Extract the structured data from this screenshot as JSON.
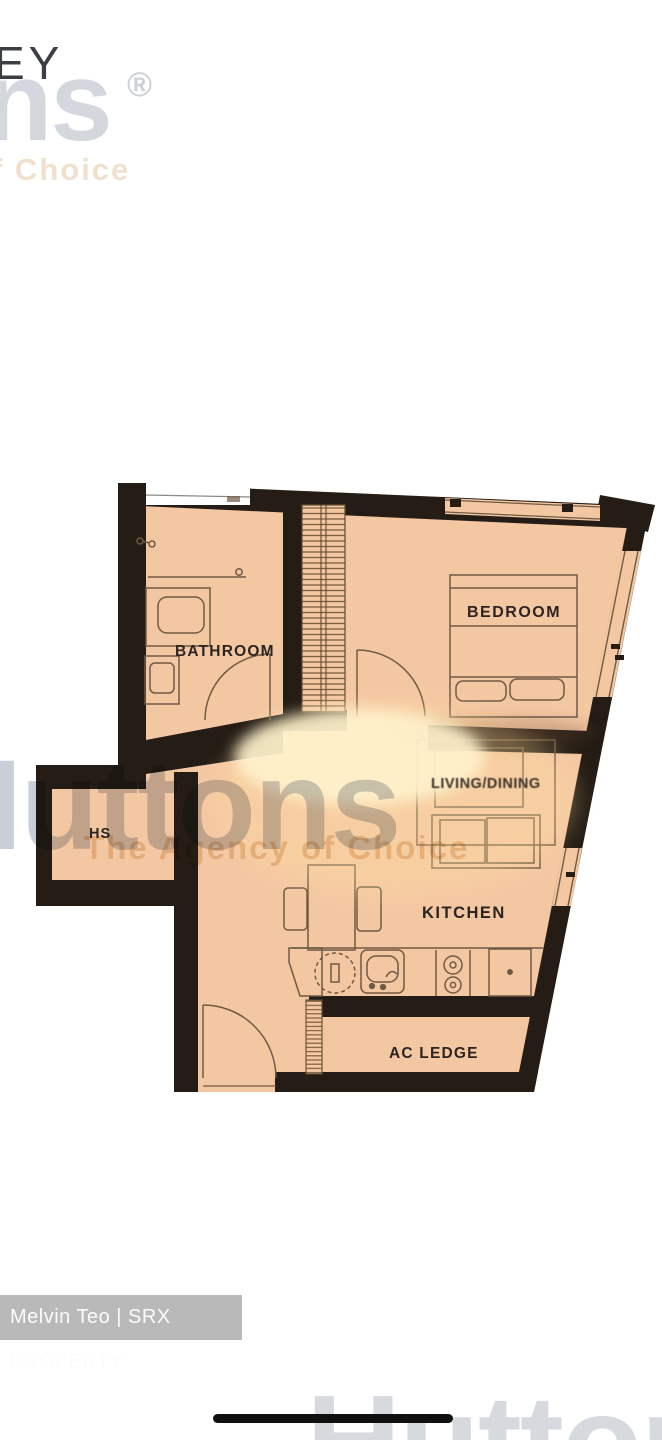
{
  "colors": {
    "floor": "#f4c7a3",
    "wall": "#241c15",
    "fixture_line": "#6f5a44",
    "glow": "#fff3cd",
    "watermark_gray": "#c9ced8",
    "watermark_tan": "#edd9bd",
    "badge_bg": "#b9b9b9",
    "badge_text": "#fcfcfc"
  },
  "watermarks": {
    "top": {
      "dark_fragment": "EY",
      "brand_fragment": "ns",
      "registered": "®",
      "tagline_fragment": "f Choice"
    },
    "middle": {
      "brand": "Huttons",
      "tagline": "The Agency of Choice"
    },
    "bottom": {
      "brand_fragment": "Hutton"
    }
  },
  "floor_plan": {
    "labels": {
      "bathroom": "BATHROOM",
      "bedroom": "BEDROOM",
      "living_dining": "LIVING/DINING",
      "kitchen": "KITCHEN",
      "household_shelter": "HS",
      "ac_ledge": "AC LEDGE"
    },
    "fixtures": [
      "bed",
      "wardrobe",
      "sofa",
      "coffee-table",
      "dining-table",
      "dining-chairs",
      "kitchen-sink",
      "washing-machine",
      "hob",
      "appliance",
      "vanity-basin",
      "toilet",
      "entrance-door",
      "bathroom-door",
      "bedroom-door",
      "windows",
      "ac-vent"
    ]
  },
  "footer": {
    "credit": "Melvin Teo | SRX PROPERTY"
  }
}
